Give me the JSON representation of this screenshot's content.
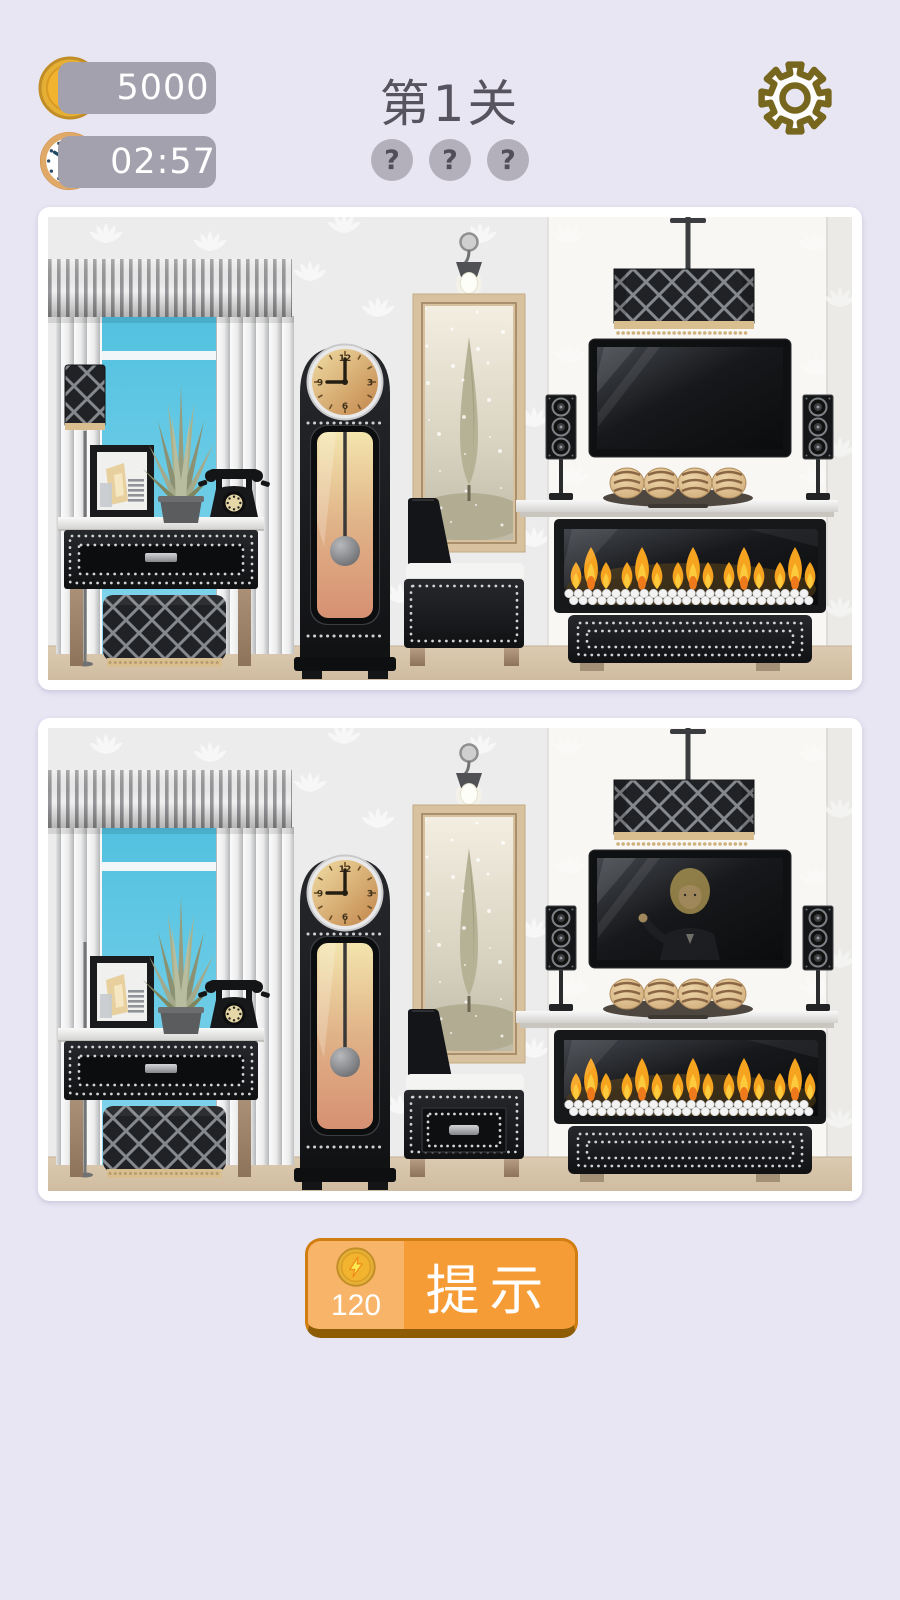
{
  "header": {
    "coins": "5000",
    "timer": "02:57",
    "level_title": "第1关",
    "hint_slots": [
      "?",
      "?",
      "?"
    ]
  },
  "hint_button": {
    "cost": "120",
    "label": "提示"
  },
  "palette": {
    "bg": "#e9e6f4",
    "pill": "#a3a1ae",
    "title": "#57545f",
    "slot": "#b3afbb",
    "slot_text": "#514e5a",
    "gear_outline": "#77671e",
    "coin_gold": "#f2b42f",
    "coin_ring": "#c08d27",
    "bolt": "#fce94f",
    "clock_ring": "#e0a967",
    "orange": "#f69c36",
    "orange_light": "#f8b468",
    "orange_dark": "#8f5c06",
    "wall": "#ececec",
    "panel": "#f8f7f4",
    "strip": "#eceae7",
    "floor1": "#dccab1",
    "floor2": "#cfbca0",
    "dark1": "#26282c",
    "dark2": "#101113",
    "stud": "#d2d3d5",
    "lattice_bg": "#202226",
    "lattice_line": "#85888c",
    "tan": "#d9bf90",
    "wood1": "#b69c82",
    "wood2": "#8d735a",
    "window1": "#52c1e0",
    "window2": "#84d6ec",
    "flame1": "#f6a41f",
    "flame2": "#fcca3d",
    "flame3": "#ee7a1c",
    "face1": "#f0dda4",
    "face2": "#c2854b",
    "mirror_frame": "#d8c19e",
    "tree": "#b5b296",
    "hair": "#ab9551",
    "skin": "#c2a36b"
  },
  "scene": {
    "differences": [
      {
        "id": "tv-person",
        "description": "figure appears on TV screen in bottom image"
      },
      {
        "id": "chair-drawer",
        "description": "armchair front has a drawer in bottom image"
      },
      {
        "id": "lamp-shade",
        "description": "table lamp shade missing in bottom image"
      }
    ],
    "scenes": [
      {
        "id": "top",
        "tv_person": false,
        "chair_drawer": false,
        "lamp_shade_missing": false
      },
      {
        "id": "bottom",
        "tv_person": true,
        "chair_drawer": true,
        "lamp_shade_missing": true
      }
    ]
  }
}
